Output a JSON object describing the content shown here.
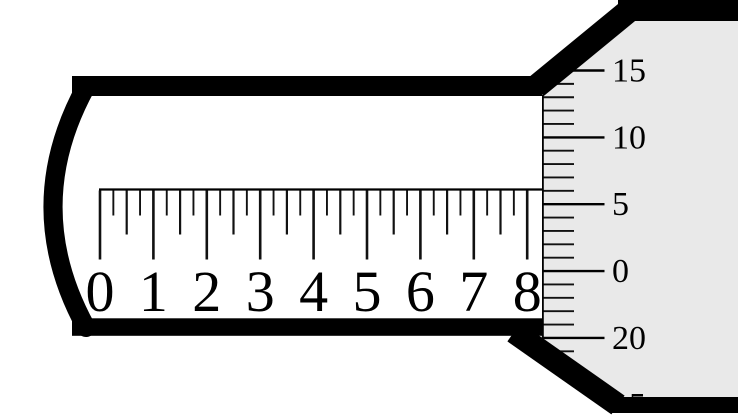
{
  "diagram": {
    "kind": "micrometer-scale-reading",
    "main_scale": {
      "numbers": [
        "0",
        "1",
        "2",
        "3",
        "4",
        "5",
        "6",
        "7",
        "8"
      ],
      "subdivisions_per_unit": 4,
      "origin_x": 100,
      "unit_spacing": 53.4,
      "line_y": 189.5,
      "number_baseline_y": 311,
      "number_font_size": 58,
      "tick_lengths": {
        "whole": 69,
        "half": 44,
        "quarter": 25
      }
    },
    "thimble_scale": {
      "labels": [
        {
          "text": "15",
          "y": 70.5,
          "partial": false
        },
        {
          "text": "10",
          "y": 137.4,
          "partial": false
        },
        {
          "text": "5",
          "y": 204.2,
          "partial": false
        },
        {
          "text": "0",
          "y": 271.1,
          "partial": false
        },
        {
          "text": "20",
          "y": 337.9,
          "partial": false
        },
        {
          "text": "15",
          "y": 404.8,
          "partial": true
        }
      ],
      "first_tick_y": 70.5,
      "minor_tick_spacing": 13.37,
      "minor_tick_count": 24,
      "edge_x": 542,
      "short_tick_end_x": 574,
      "long_tick_end_x": 604.5,
      "label_x": 612,
      "label_font_size": 34
    },
    "colors": {
      "ink": "#000000",
      "tick": "#111111",
      "thimble_fill": "#e9e9e9",
      "background": "#ffffff"
    }
  }
}
